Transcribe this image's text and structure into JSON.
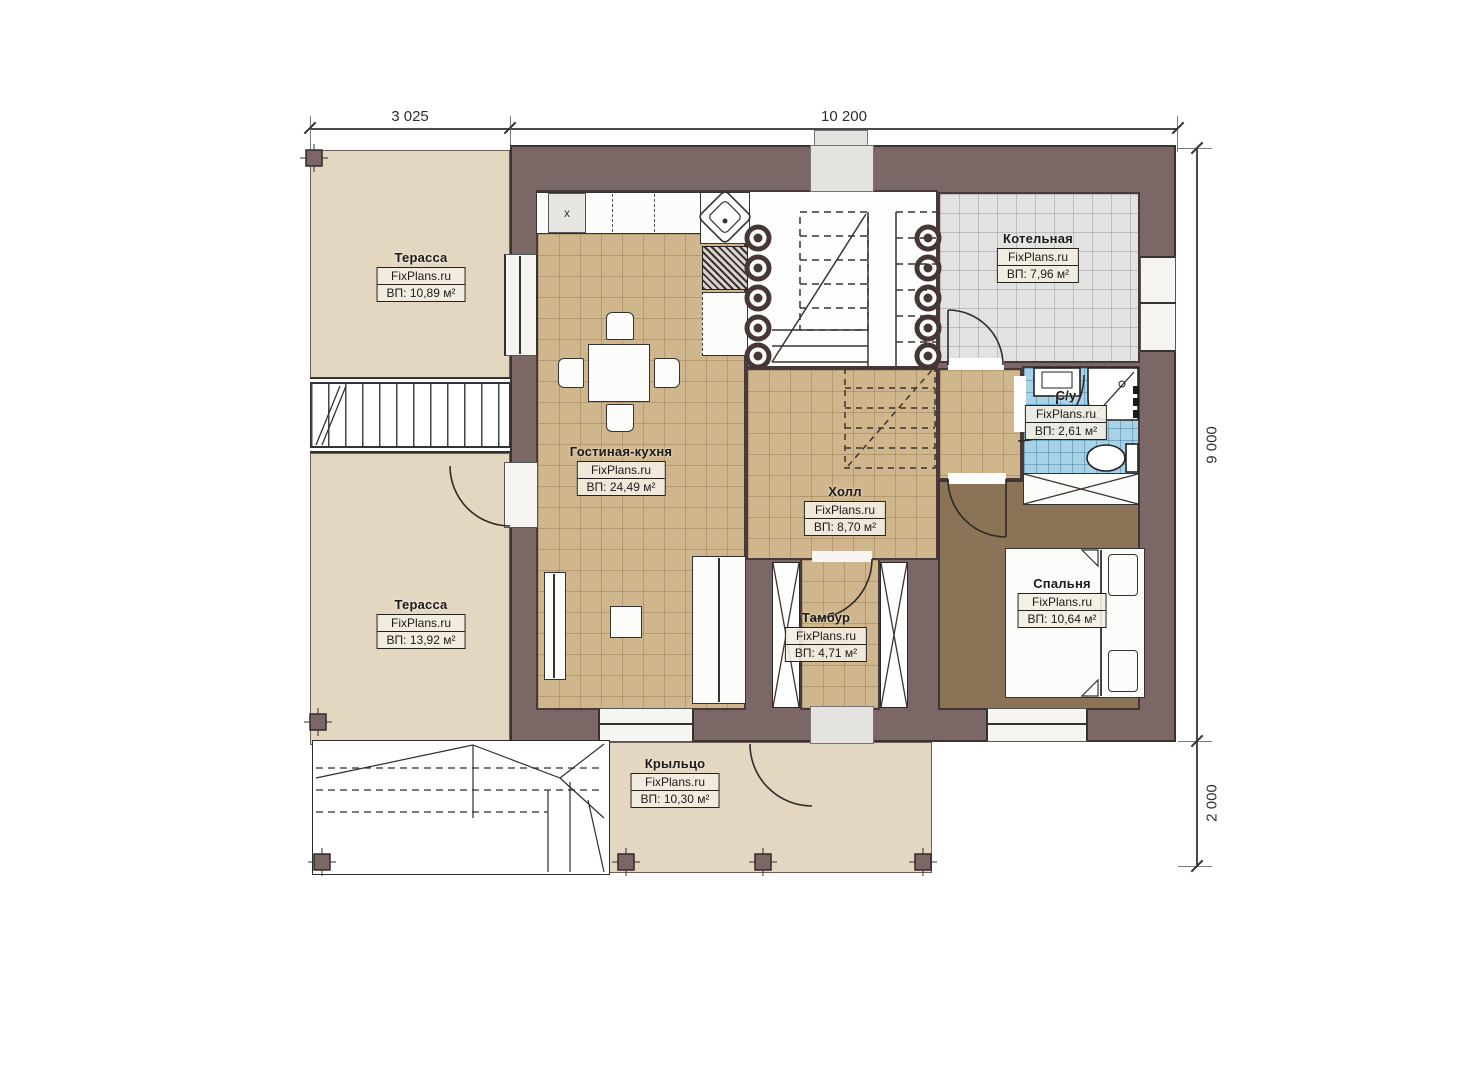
{
  "plan": {
    "dimensions": {
      "width_left": "3 025",
      "width_right": "10 200",
      "height_main": "9 000",
      "height_porch": "2 000"
    },
    "rooms": {
      "terrace_top": {
        "name": "Терасса",
        "brand": "FixPlans.ru",
        "area": "ВП: 10,89 м²"
      },
      "terrace_bottom": {
        "name": "Терасса",
        "brand": "FixPlans.ru",
        "area": "ВП: 13,92 м²"
      },
      "living_kitchen": {
        "name": "Гостиная-кухня",
        "brand": "FixPlans.ru",
        "area": "ВП: 24,49 м²"
      },
      "boiler": {
        "name": "Котельная",
        "brand": "FixPlans.ru",
        "area": "ВП: 7,96 м²"
      },
      "bathroom": {
        "name": "С/у",
        "brand": "FixPlans.ru",
        "area": "ВП: 2,61 м²"
      },
      "hall": {
        "name": "Холл",
        "brand": "FixPlans.ru",
        "area": "ВП: 8,70 м²"
      },
      "bedroom": {
        "name": "Спальня",
        "brand": "FixPlans.ru",
        "area": "ВП: 10,64 м²"
      },
      "vestibule": {
        "name": "Тамбур",
        "brand": "FixPlans.ru",
        "area": "ВП: 4,71 м²"
      },
      "porch": {
        "name": "Крыльцо",
        "brand": "FixPlans.ru",
        "area": "ВП: 10,30 м²"
      }
    },
    "kitchen": {
      "marker": "x"
    },
    "colors": {
      "wall": "#7b6766",
      "terrace": "#e4d7c1",
      "tile_tan": "#d0b68c",
      "tile_gray": "#e2e2e0",
      "tile_blue": "#a8d2e5",
      "floor_bedroom": "#8a7356"
    }
  }
}
